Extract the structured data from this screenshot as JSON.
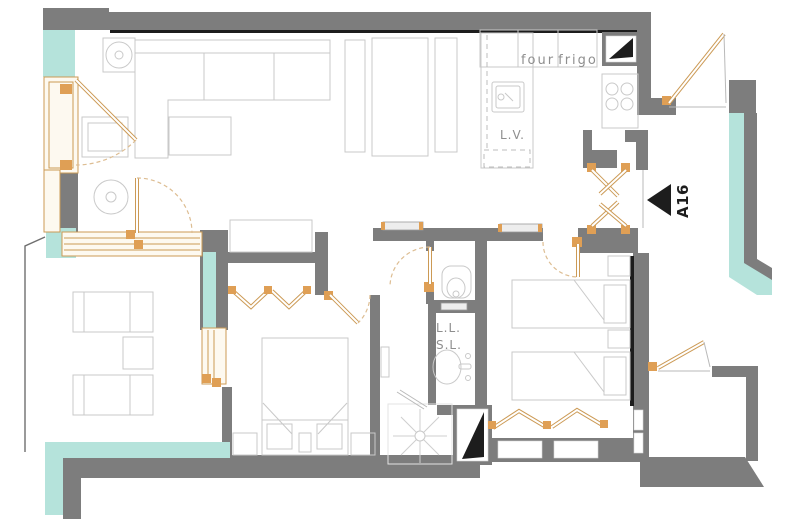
{
  "unit": {
    "label": "A16",
    "arrow_icon": "triangle-left"
  },
  "kitchen": {
    "oven_label": "four",
    "fridge_label": "frigo",
    "dishwasher_label": "L.V."
  },
  "bathroom": {
    "washing_machine_label": "L.L.",
    "dryer_label": "S.L."
  },
  "colors": {
    "wall": "#7d7d7d",
    "black": "#1d1d1d",
    "glass": "#b5e3db",
    "frame": "#cc9a55",
    "hinge": "#df9f55",
    "arc": "#ddbd92",
    "furniture": "#c9c9c9",
    "label": "#8e8e8e"
  }
}
